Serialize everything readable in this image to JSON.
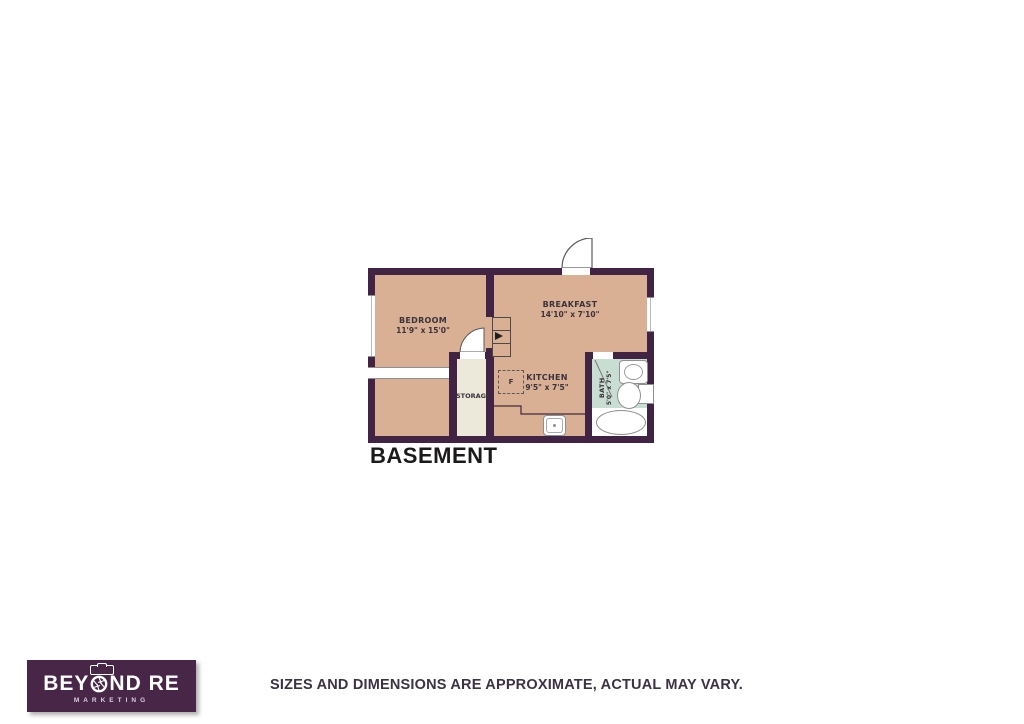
{
  "floor_plan": {
    "title": "BASEMENT",
    "rooms": [
      {
        "name": "BEDROOM",
        "dimensions": "11'9\" x 15'0\""
      },
      {
        "name": "BREAKFAST",
        "dimensions": "14'10\" x 7'10\""
      },
      {
        "name": "KITCHEN",
        "dimensions": "9'5\" x 7'5\""
      },
      {
        "name": "STORAGE",
        "dimensions": ""
      },
      {
        "name": "BATH",
        "dimensions": "5'0\" x 7'5\""
      }
    ],
    "furnace_label": "F",
    "colors": {
      "wall": "#412343",
      "room_fill": "#d9b094",
      "storage_fill": "#ece8da",
      "bath_fill": "#c9ded3",
      "label_text": "#3a323c"
    }
  },
  "footer": {
    "logo": {
      "line1_pre": "BEY",
      "line1_post": "ND RE",
      "line2": "MARKETING",
      "background": "#482648"
    },
    "disclaimer": "SIZES AND DIMENSIONS ARE APPROXIMATE, ACTUAL MAY VARY."
  }
}
